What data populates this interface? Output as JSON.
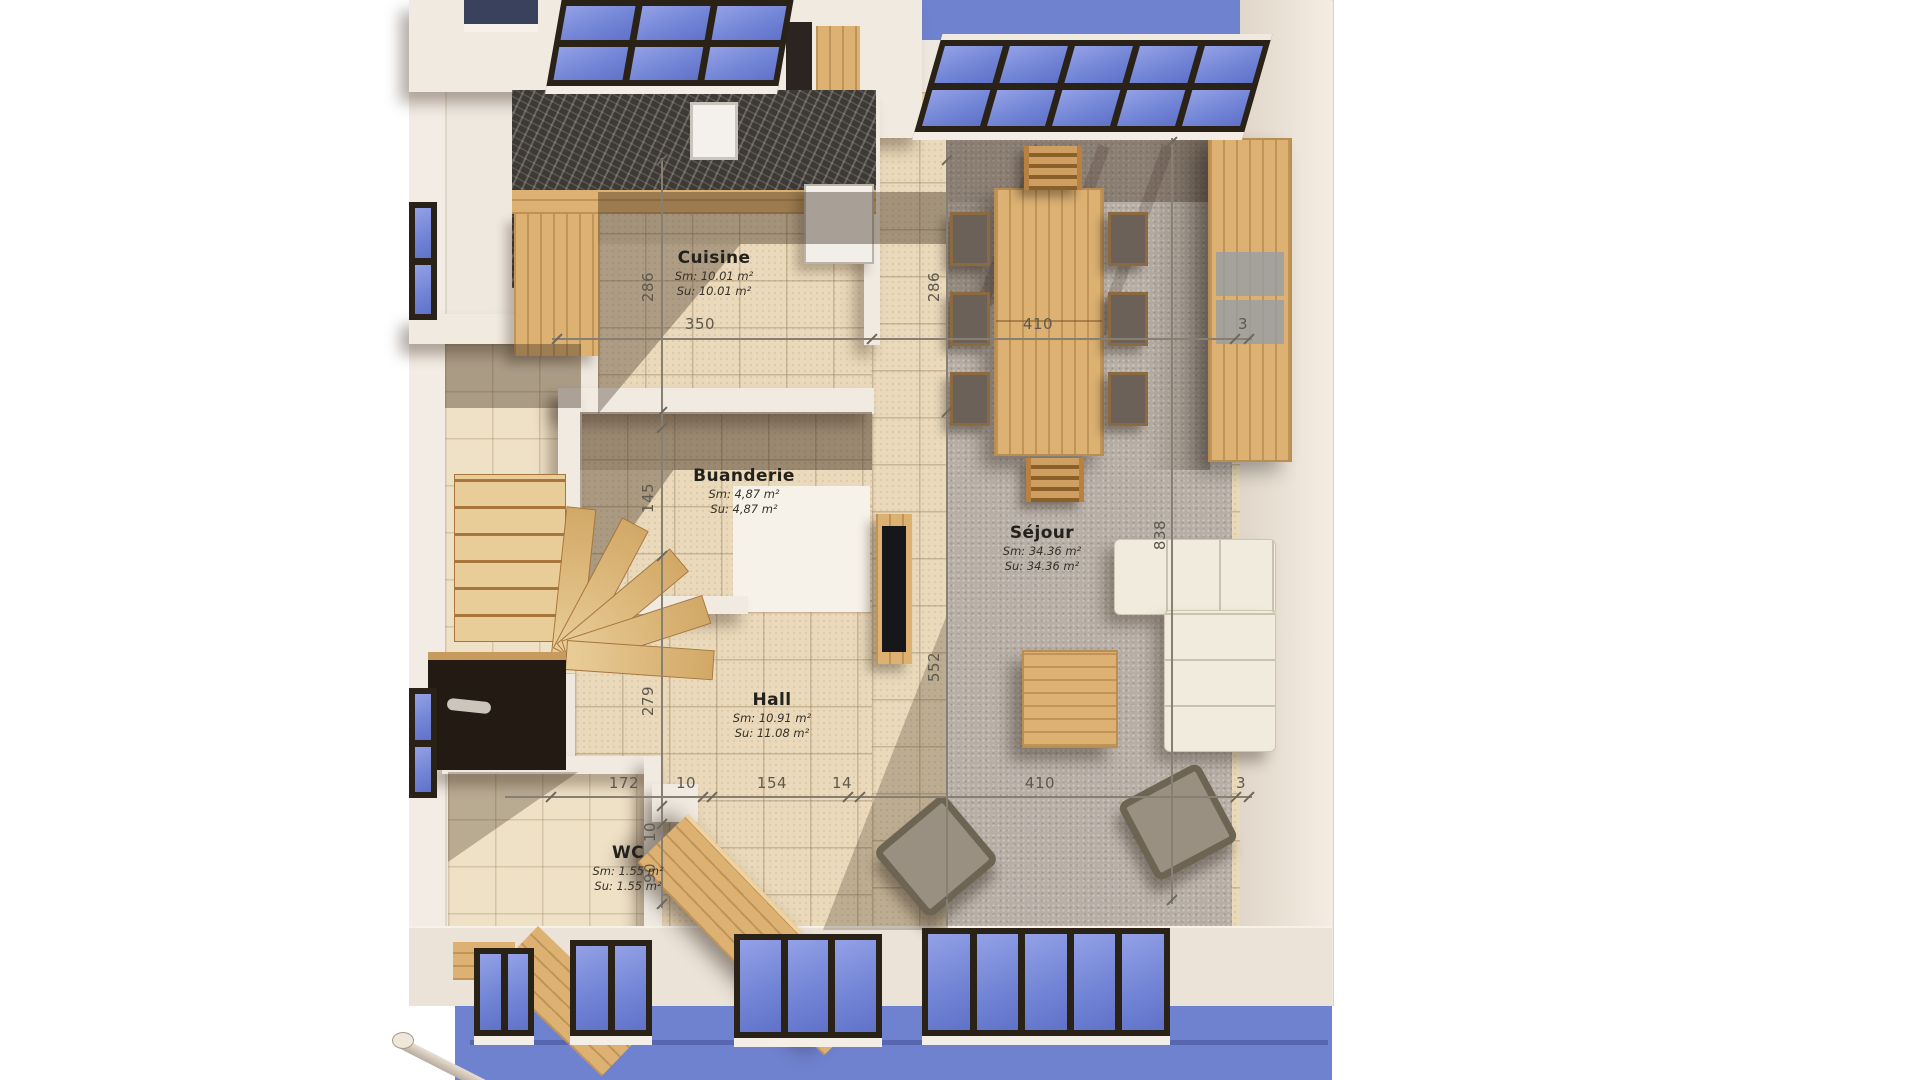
{
  "plan": {
    "rooms": {
      "cuisine": {
        "name": "Cuisine",
        "sm": "Sm: 10.01 m²",
        "su": "Su: 10.01 m²"
      },
      "buanderie": {
        "name": "Buanderie",
        "sm": "Sm: 4,87 m²",
        "su": "Su: 4,87 m²"
      },
      "sejour": {
        "name": "Séjour",
        "sm": "Sm: 34.36 m²",
        "su": "Su: 34.36 m²"
      },
      "hall": {
        "name": "Hall",
        "sm": "Sm: 10.91 m²",
        "su": "Su: 11.08 m²"
      },
      "wc": {
        "name": "WC",
        "sm": "Sm: 1.55 m²",
        "su": "Su: 1.55 m²"
      }
    },
    "dimensions": {
      "top": {
        "d1": "350",
        "d2": "410",
        "d3": "3"
      },
      "bottom": {
        "d1": "172",
        "d2": "10",
        "d3": "154",
        "d4": "14",
        "d5": "410",
        "d6": "3"
      },
      "left": {
        "d1": "286",
        "d2": "145",
        "d3": "279",
        "d4": "10",
        "d5": "90"
      },
      "inner_right": {
        "d1": "286",
        "d2": "552"
      },
      "outer_right": {
        "d1": "838"
      }
    },
    "colors": {
      "glass": "#7a8bd8",
      "sky": "#6f82cf",
      "wall": "#efe8df",
      "tile": "#ead9ba",
      "carpet": "#b7aea5",
      "wood": "#dcb172",
      "marble": "#3d3935"
    }
  }
}
